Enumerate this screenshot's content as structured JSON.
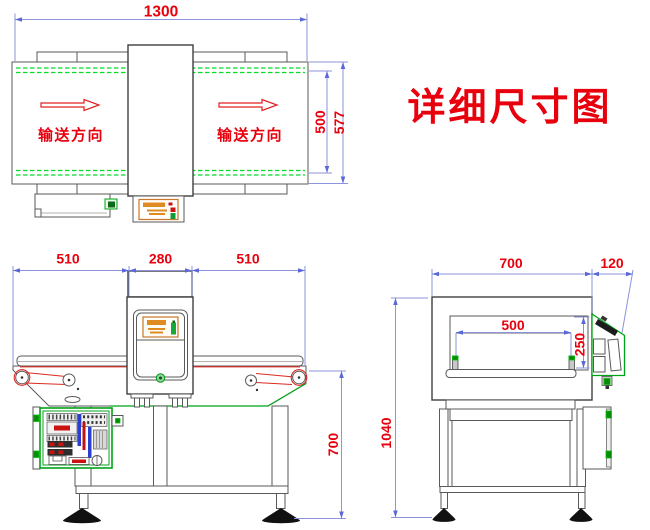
{
  "title": "详细尺寸图",
  "labels": {
    "direction": "输送方向"
  },
  "dimensions": {
    "top_view": {
      "length": "1300",
      "belt_width": "500",
      "frame_width": "577"
    },
    "front_view": {
      "left_span": "510",
      "detector_width": "280",
      "right_span": "510",
      "belt_height": "700"
    },
    "side_view": {
      "body_width": "700",
      "panel_offset": "120",
      "aperture_width": "500",
      "aperture_height": "250",
      "total_height": "1040"
    }
  },
  "colors": {
    "dimension_line": "#8b93dd",
    "dimension_arrow": "#5b68d8",
    "dimension_text": "#e8000d",
    "belt_guide": "#00dc28",
    "machine_green": "#00a318",
    "red_accent": "#d92b21",
    "outline": "#5a5a5a",
    "orange_accent": "#e08a24"
  },
  "icons": {
    "direction_arrow": "arrow-right-icon"
  }
}
